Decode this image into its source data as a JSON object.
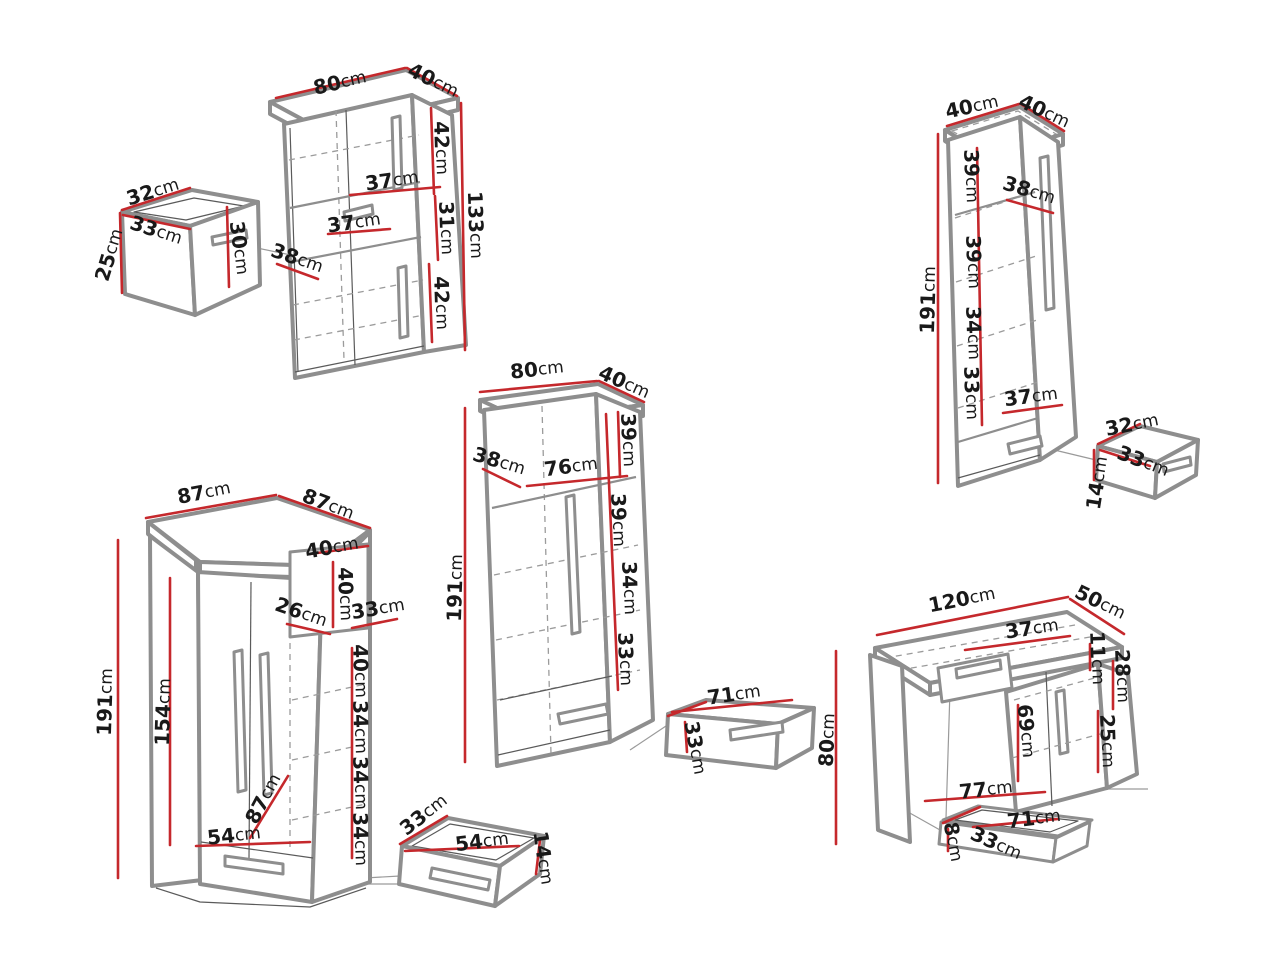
{
  "meta": {
    "unit": "cm",
    "description": "Furniture set technical dimension diagram"
  },
  "colors": {
    "dimension_line": "#c5282c",
    "outline": "#8e8e8e",
    "text": "#191919",
    "background": "#ffffff"
  },
  "pieces": [
    {
      "id": "top-left-open-box",
      "labels": [
        {
          "text": "32cm",
          "x": 153,
          "y": 192,
          "r": -17
        },
        {
          "text": "33cm",
          "x": 156,
          "y": 231,
          "r": 18
        },
        {
          "text": "25cm",
          "x": 110,
          "y": 255,
          "r": -73
        },
        {
          "text": "30cm",
          "x": 239,
          "y": 248,
          "r": 83
        }
      ]
    },
    {
      "id": "two-door-bookcase",
      "labels": [
        {
          "text": "80cm",
          "x": 340,
          "y": 83,
          "r": -13
        },
        {
          "text": "40cm",
          "x": 433,
          "y": 81,
          "r": 26
        },
        {
          "text": "42cm",
          "x": 441,
          "y": 148,
          "r": 88
        },
        {
          "text": "37cm",
          "x": 392,
          "y": 181,
          "r": -8
        },
        {
          "text": "37cm",
          "x": 354,
          "y": 223,
          "r": -8
        },
        {
          "text": "31cm",
          "x": 446,
          "y": 228,
          "r": 88
        },
        {
          "text": "42cm",
          "x": 441,
          "y": 303,
          "r": 88
        },
        {
          "text": "38cm",
          "x": 297,
          "y": 259,
          "r": 19
        },
        {
          "text": "133cm",
          "x": 475,
          "y": 225,
          "r": 88
        }
      ]
    },
    {
      "id": "tall-single-wardrobe",
      "labels": [
        {
          "text": "40cm",
          "x": 972,
          "y": 107,
          "r": -12
        },
        {
          "text": "40cm",
          "x": 1044,
          "y": 112,
          "r": 25
        },
        {
          "text": "39cm",
          "x": 971,
          "y": 176,
          "r": 88
        },
        {
          "text": "38cm",
          "x": 1029,
          "y": 191,
          "r": 17
        },
        {
          "text": "39cm",
          "x": 973,
          "y": 262,
          "r": 88
        },
        {
          "text": "34cm",
          "x": 973,
          "y": 333,
          "r": 88
        },
        {
          "text": "33cm",
          "x": 971,
          "y": 393,
          "r": 88
        },
        {
          "text": "37cm",
          "x": 1031,
          "y": 397,
          "r": -7
        },
        {
          "text": "191cm",
          "x": 929,
          "y": 300,
          "r": -88
        }
      ]
    },
    {
      "id": "small-drawer-right",
      "labels": [
        {
          "text": "32cm",
          "x": 1132,
          "y": 425,
          "r": -11
        },
        {
          "text": "33cm",
          "x": 1143,
          "y": 462,
          "r": 21
        },
        {
          "text": "14cm",
          "x": 1098,
          "y": 483,
          "r": -81
        }
      ]
    },
    {
      "id": "double-wardrobe-center",
      "labels": [
        {
          "text": "80cm",
          "x": 537,
          "y": 370,
          "r": -6
        },
        {
          "text": "40cm",
          "x": 624,
          "y": 383,
          "r": 24
        },
        {
          "text": "39cm",
          "x": 628,
          "y": 440,
          "r": 88
        },
        {
          "text": "38cm",
          "x": 499,
          "y": 462,
          "r": 17
        },
        {
          "text": "76cm",
          "x": 571,
          "y": 467,
          "r": -7
        },
        {
          "text": "39cm",
          "x": 618,
          "y": 520,
          "r": 88
        },
        {
          "text": "34cm",
          "x": 629,
          "y": 588,
          "r": 88
        },
        {
          "text": "33cm",
          "x": 625,
          "y": 659,
          "r": 88
        },
        {
          "text": "191cm",
          "x": 456,
          "y": 588,
          "r": -88
        }
      ]
    },
    {
      "id": "center-drawer",
      "labels": [
        {
          "text": "71cm",
          "x": 734,
          "y": 695,
          "r": -8
        },
        {
          "text": "33cm",
          "x": 695,
          "y": 748,
          "r": 80
        }
      ]
    },
    {
      "id": "corner-wardrobe",
      "labels": [
        {
          "text": "87cm",
          "x": 204,
          "y": 493,
          "r": -11
        },
        {
          "text": "87cm",
          "x": 328,
          "y": 505,
          "r": 21
        },
        {
          "text": "40cm",
          "x": 332,
          "y": 548,
          "r": -10
        },
        {
          "text": "40cm",
          "x": 345,
          "y": 594,
          "r": 88
        },
        {
          "text": "26cm",
          "x": 301,
          "y": 613,
          "r": 19
        },
        {
          "text": "33cm",
          "x": 378,
          "y": 609,
          "r": -9
        },
        {
          "text": "40cm",
          "x": 360,
          "y": 671,
          "r": 88
        },
        {
          "text": "34cm",
          "x": 360,
          "y": 727,
          "r": 88
        },
        {
          "text": "34cm",
          "x": 360,
          "y": 783,
          "r": 88
        },
        {
          "text": "34cm",
          "x": 360,
          "y": 839,
          "r": 88
        },
        {
          "text": "154cm",
          "x": 164,
          "y": 712,
          "r": -88
        },
        {
          "text": "191cm",
          "x": 106,
          "y": 702,
          "r": -88
        },
        {
          "text": "87cm",
          "x": 264,
          "y": 799,
          "r": -62
        },
        {
          "text": "54cm",
          "x": 234,
          "y": 836,
          "r": -6
        }
      ]
    },
    {
      "id": "bottom-drawer",
      "labels": [
        {
          "text": "33cm",
          "x": 424,
          "y": 815,
          "r": -38
        },
        {
          "text": "54cm",
          "x": 482,
          "y": 842,
          "r": -7
        },
        {
          "text": "14cm",
          "x": 543,
          "y": 858,
          "r": 82
        }
      ]
    },
    {
      "id": "desk",
      "labels": [
        {
          "text": "120cm",
          "x": 962,
          "y": 600,
          "r": -11
        },
        {
          "text": "50cm",
          "x": 1100,
          "y": 603,
          "r": 26
        },
        {
          "text": "37cm",
          "x": 1032,
          "y": 629,
          "r": -8
        },
        {
          "text": "11cm",
          "x": 1097,
          "y": 658,
          "r": 88
        },
        {
          "text": "28cm",
          "x": 1122,
          "y": 676,
          "r": 88
        },
        {
          "text": "69cm",
          "x": 1026,
          "y": 731,
          "r": 85
        },
        {
          "text": "25cm",
          "x": 1107,
          "y": 741,
          "r": 88
        },
        {
          "text": "80cm",
          "x": 828,
          "y": 740,
          "r": -87
        },
        {
          "text": "77cm",
          "x": 986,
          "y": 790,
          "r": -6
        },
        {
          "text": "71cm",
          "x": 1034,
          "y": 819,
          "r": -7
        },
        {
          "text": "8cm",
          "x": 953,
          "y": 842,
          "r": 80
        },
        {
          "text": "33cm",
          "x": 996,
          "y": 844,
          "r": 24
        }
      ]
    }
  ]
}
